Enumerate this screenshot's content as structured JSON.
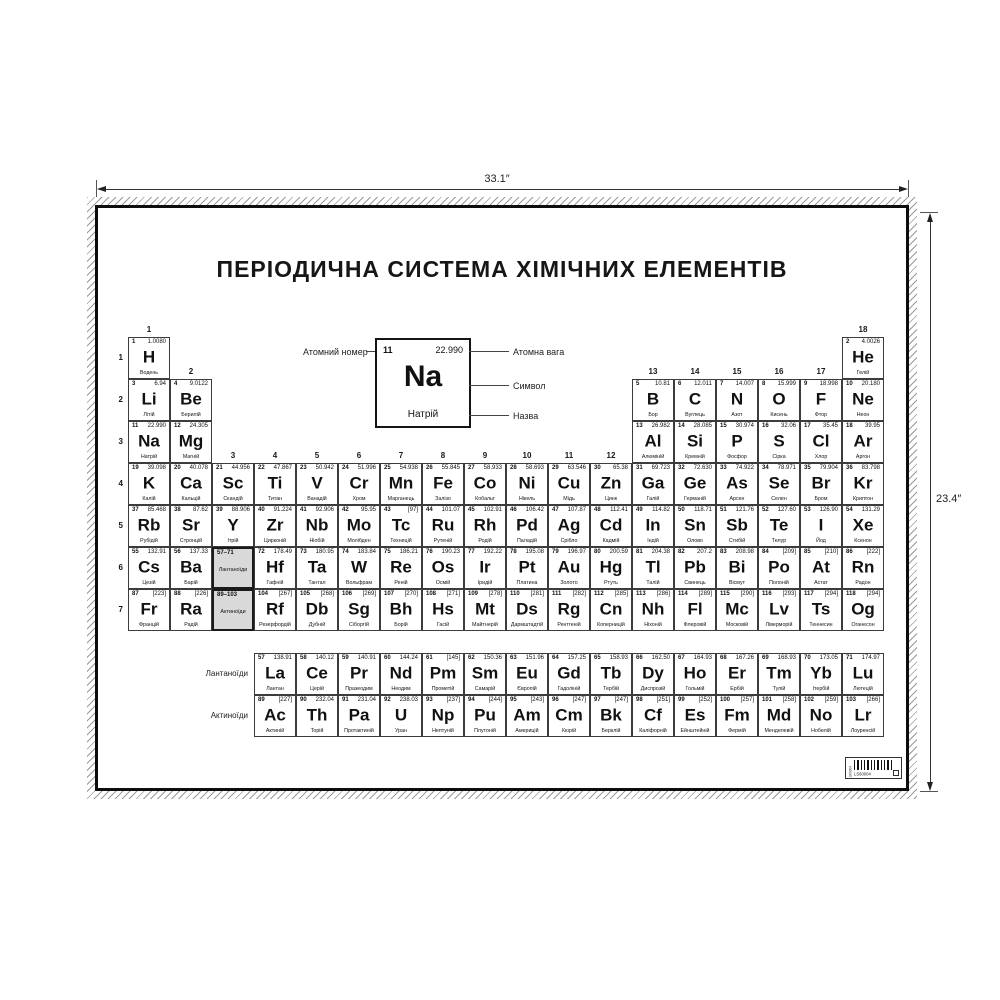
{
  "dimensions": {
    "width_label": "33.1″",
    "height_label": "23.4″"
  },
  "poster": {
    "title": "ПЕРІОДИЧНА СИСТЕМА ХІМІЧНИХ ЕЛЕМЕНТІВ",
    "legend": {
      "atomic_number_label": "Атомний номер",
      "atomic_weight_label": "Атомна вага",
      "symbol_label": "Символ",
      "name_label": "Назва",
      "example": {
        "number": "11",
        "mass": "22.990",
        "symbol": "Na",
        "name": "Натрій"
      }
    },
    "period_labels": [
      "1",
      "2",
      "3",
      "4",
      "5",
      "6",
      "7"
    ],
    "group_headers": [
      {
        "label": "1",
        "col": 1,
        "row": 1
      },
      {
        "label": "2",
        "col": 2,
        "row": 2
      },
      {
        "label": "3",
        "col": 3,
        "row": 4
      },
      {
        "label": "4",
        "col": 4,
        "row": 4
      },
      {
        "label": "5",
        "col": 5,
        "row": 4
      },
      {
        "label": "6",
        "col": 6,
        "row": 4
      },
      {
        "label": "7",
        "col": 7,
        "row": 4
      },
      {
        "label": "8",
        "col": 8,
        "row": 4
      },
      {
        "label": "9",
        "col": 9,
        "row": 4
      },
      {
        "label": "10",
        "col": 10,
        "row": 4
      },
      {
        "label": "11",
        "col": 11,
        "row": 4
      },
      {
        "label": "12",
        "col": 12,
        "row": 4
      },
      {
        "label": "13",
        "col": 13,
        "row": 2
      },
      {
        "label": "14",
        "col": 14,
        "row": 2
      },
      {
        "label": "15",
        "col": 15,
        "row": 2
      },
      {
        "label": "16",
        "col": 16,
        "row": 2
      },
      {
        "label": "17",
        "col": 17,
        "row": 2
      },
      {
        "label": "18",
        "col": 18,
        "row": 1
      }
    ],
    "placeholders": [
      {
        "range": "57–71",
        "label": "Лантаноїди",
        "col": 3,
        "row": 6
      },
      {
        "range": "89–103",
        "label": "Актиноїди",
        "col": 3,
        "row": 7
      }
    ],
    "series_labels": {
      "lanthanides": "Лантаноїди",
      "actinides": "Актиноїди"
    },
    "elements": [
      {
        "n": "1",
        "s": "H",
        "m": "1.0080",
        "name": "Водень",
        "g": 1,
        "p": 1
      },
      {
        "n": "2",
        "s": "He",
        "m": "4.0026",
        "name": "Гелій",
        "g": 18,
        "p": 1
      },
      {
        "n": "3",
        "s": "Li",
        "m": "6.94",
        "name": "Літій",
        "g": 1,
        "p": 2
      },
      {
        "n": "4",
        "s": "Be",
        "m": "9.0122",
        "name": "Берилій",
        "g": 2,
        "p": 2
      },
      {
        "n": "5",
        "s": "B",
        "m": "10.81",
        "name": "Бор",
        "g": 13,
        "p": 2
      },
      {
        "n": "6",
        "s": "C",
        "m": "12.011",
        "name": "Вуглець",
        "g": 14,
        "p": 2
      },
      {
        "n": "7",
        "s": "N",
        "m": "14.007",
        "name": "Азот",
        "g": 15,
        "p": 2
      },
      {
        "n": "8",
        "s": "O",
        "m": "15.999",
        "name": "Кисень",
        "g": 16,
        "p": 2
      },
      {
        "n": "9",
        "s": "F",
        "m": "18.998",
        "name": "Фтор",
        "g": 17,
        "p": 2
      },
      {
        "n": "10",
        "s": "Ne",
        "m": "20.180",
        "name": "Неон",
        "g": 18,
        "p": 2
      },
      {
        "n": "11",
        "s": "Na",
        "m": "22.990",
        "name": "Натрій",
        "g": 1,
        "p": 3
      },
      {
        "n": "12",
        "s": "Mg",
        "m": "24.305",
        "name": "Магній",
        "g": 2,
        "p": 3
      },
      {
        "n": "13",
        "s": "Al",
        "m": "26.982",
        "name": "Алюміній",
        "g": 13,
        "p": 3
      },
      {
        "n": "14",
        "s": "Si",
        "m": "28.085",
        "name": "Кремній",
        "g": 14,
        "p": 3
      },
      {
        "n": "15",
        "s": "P",
        "m": "30.974",
        "name": "Фосфор",
        "g": 15,
        "p": 3
      },
      {
        "n": "16",
        "s": "S",
        "m": "32.06",
        "name": "Сірка",
        "g": 16,
        "p": 3
      },
      {
        "n": "17",
        "s": "Cl",
        "m": "35.45",
        "name": "Хлор",
        "g": 17,
        "p": 3
      },
      {
        "n": "18",
        "s": "Ar",
        "m": "39.95",
        "name": "Аргон",
        "g": 18,
        "p": 3
      },
      {
        "n": "19",
        "s": "K",
        "m": "39.098",
        "name": "Калій",
        "g": 1,
        "p": 4
      },
      {
        "n": "20",
        "s": "Ca",
        "m": "40.078",
        "name": "Кальцій",
        "g": 2,
        "p": 4
      },
      {
        "n": "21",
        "s": "Sc",
        "m": "44.956",
        "name": "Скандій",
        "g": 3,
        "p": 4
      },
      {
        "n": "22",
        "s": "Ti",
        "m": "47.867",
        "name": "Титан",
        "g": 4,
        "p": 4
      },
      {
        "n": "23",
        "s": "V",
        "m": "50.942",
        "name": "Ванадій",
        "g": 5,
        "p": 4
      },
      {
        "n": "24",
        "s": "Cr",
        "m": "51.996",
        "name": "Хром",
        "g": 6,
        "p": 4
      },
      {
        "n": "25",
        "s": "Mn",
        "m": "54.938",
        "name": "Марганець",
        "g": 7,
        "p": 4
      },
      {
        "n": "26",
        "s": "Fe",
        "m": "55.845",
        "name": "Залізо",
        "g": 8,
        "p": 4
      },
      {
        "n": "27",
        "s": "Co",
        "m": "58.933",
        "name": "Кобальт",
        "g": 9,
        "p": 4
      },
      {
        "n": "28",
        "s": "Ni",
        "m": "58.693",
        "name": "Нікель",
        "g": 10,
        "p": 4
      },
      {
        "n": "29",
        "s": "Cu",
        "m": "63.546",
        "name": "Мідь",
        "g": 11,
        "p": 4
      },
      {
        "n": "30",
        "s": "Zn",
        "m": "65.38",
        "name": "Цинк",
        "g": 12,
        "p": 4
      },
      {
        "n": "31",
        "s": "Ga",
        "m": "69.723",
        "name": "Галій",
        "g": 13,
        "p": 4
      },
      {
        "n": "32",
        "s": "Ge",
        "m": "72.630",
        "name": "Германій",
        "g": 14,
        "p": 4
      },
      {
        "n": "33",
        "s": "As",
        "m": "74.922",
        "name": "Арсен",
        "g": 15,
        "p": 4
      },
      {
        "n": "34",
        "s": "Se",
        "m": "78.971",
        "name": "Селен",
        "g": 16,
        "p": 4
      },
      {
        "n": "35",
        "s": "Br",
        "m": "79.904",
        "name": "Бром",
        "g": 17,
        "p": 4
      },
      {
        "n": "36",
        "s": "Kr",
        "m": "83.798",
        "name": "Криптон",
        "g": 18,
        "p": 4
      },
      {
        "n": "37",
        "s": "Rb",
        "m": "85.468",
        "name": "Рубідій",
        "g": 1,
        "p": 5
      },
      {
        "n": "38",
        "s": "Sr",
        "m": "87.62",
        "name": "Стронцій",
        "g": 2,
        "p": 5
      },
      {
        "n": "39",
        "s": "Y",
        "m": "88.906",
        "name": "Ітрій",
        "g": 3,
        "p": 5
      },
      {
        "n": "40",
        "s": "Zr",
        "m": "91.224",
        "name": "Цирконій",
        "g": 4,
        "p": 5
      },
      {
        "n": "41",
        "s": "Nb",
        "m": "92.906",
        "name": "Ніобій",
        "g": 5,
        "p": 5
      },
      {
        "n": "42",
        "s": "Mo",
        "m": "95.95",
        "name": "Молібден",
        "g": 6,
        "p": 5
      },
      {
        "n": "43",
        "s": "Tc",
        "m": "[97]",
        "name": "Технецій",
        "g": 7,
        "p": 5
      },
      {
        "n": "44",
        "s": "Ru",
        "m": "101.07",
        "name": "Рутеній",
        "g": 8,
        "p": 5
      },
      {
        "n": "45",
        "s": "Rh",
        "m": "102.91",
        "name": "Родій",
        "g": 9,
        "p": 5
      },
      {
        "n": "46",
        "s": "Pd",
        "m": "106.42",
        "name": "Паладій",
        "g": 10,
        "p": 5
      },
      {
        "n": "47",
        "s": "Ag",
        "m": "107.87",
        "name": "Срібло",
        "g": 11,
        "p": 5
      },
      {
        "n": "48",
        "s": "Cd",
        "m": "112.41",
        "name": "Кадмій",
        "g": 12,
        "p": 5
      },
      {
        "n": "49",
        "s": "In",
        "m": "114.82",
        "name": "Індій",
        "g": 13,
        "p": 5
      },
      {
        "n": "50",
        "s": "Sn",
        "m": "118.71",
        "name": "Олово",
        "g": 14,
        "p": 5
      },
      {
        "n": "51",
        "s": "Sb",
        "m": "121.76",
        "name": "Стибій",
        "g": 15,
        "p": 5
      },
      {
        "n": "52",
        "s": "Te",
        "m": "127.60",
        "name": "Телур",
        "g": 16,
        "p": 5
      },
      {
        "n": "53",
        "s": "I",
        "m": "126.90",
        "name": "Йод",
        "g": 17,
        "p": 5
      },
      {
        "n": "54",
        "s": "Xe",
        "m": "131.29",
        "name": "Ксенон",
        "g": 18,
        "p": 5
      },
      {
        "n": "55",
        "s": "Cs",
        "m": "132.91",
        "name": "Цезій",
        "g": 1,
        "p": 6
      },
      {
        "n": "56",
        "s": "Ba",
        "m": "137.33",
        "name": "Барій",
        "g": 2,
        "p": 6
      },
      {
        "n": "72",
        "s": "Hf",
        "m": "178.49",
        "name": "Гафній",
        "g": 4,
        "p": 6
      },
      {
        "n": "73",
        "s": "Ta",
        "m": "180.95",
        "name": "Тантал",
        "g": 5,
        "p": 6
      },
      {
        "n": "74",
        "s": "W",
        "m": "183.84",
        "name": "Вольфрам",
        "g": 6,
        "p": 6
      },
      {
        "n": "75",
        "s": "Re",
        "m": "186.21",
        "name": "Реній",
        "g": 7,
        "p": 6
      },
      {
        "n": "76",
        "s": "Os",
        "m": "190.23",
        "name": "Осмій",
        "g": 8,
        "p": 6
      },
      {
        "n": "77",
        "s": "Ir",
        "m": "192.22",
        "name": "Іридій",
        "g": 9,
        "p": 6
      },
      {
        "n": "78",
        "s": "Pt",
        "m": "195.08",
        "name": "Платина",
        "g": 10,
        "p": 6
      },
      {
        "n": "79",
        "s": "Au",
        "m": "196.97",
        "name": "Золото",
        "g": 11,
        "p": 6
      },
      {
        "n": "80",
        "s": "Hg",
        "m": "200.59",
        "name": "Ртуть",
        "g": 12,
        "p": 6
      },
      {
        "n": "81",
        "s": "Tl",
        "m": "204.38",
        "name": "Талій",
        "g": 13,
        "p": 6
      },
      {
        "n": "82",
        "s": "Pb",
        "m": "207.2",
        "name": "Свинець",
        "g": 14,
        "p": 6
      },
      {
        "n": "83",
        "s": "Bi",
        "m": "208.98",
        "name": "Вісмут",
        "g": 15,
        "p": 6
      },
      {
        "n": "84",
        "s": "Po",
        "m": "[209]",
        "name": "Полоній",
        "g": 16,
        "p": 6
      },
      {
        "n": "85",
        "s": "At",
        "m": "[210]",
        "name": "Астат",
        "g": 17,
        "p": 6
      },
      {
        "n": "86",
        "s": "Rn",
        "m": "[222]",
        "name": "Радон",
        "g": 18,
        "p": 6
      },
      {
        "n": "87",
        "s": "Fr",
        "m": "[223]",
        "name": "Францій",
        "g": 1,
        "p": 7
      },
      {
        "n": "88",
        "s": "Ra",
        "m": "[226]",
        "name": "Радій",
        "g": 2,
        "p": 7
      },
      {
        "n": "104",
        "s": "Rf",
        "m": "[267]",
        "name": "Резерфордій",
        "g": 4,
        "p": 7
      },
      {
        "n": "105",
        "s": "Db",
        "m": "[268]",
        "name": "Дубній",
        "g": 5,
        "p": 7
      },
      {
        "n": "106",
        "s": "Sg",
        "m": "[269]",
        "name": "Сіборгій",
        "g": 6,
        "p": 7
      },
      {
        "n": "107",
        "s": "Bh",
        "m": "[270]",
        "name": "Борій",
        "g": 7,
        "p": 7
      },
      {
        "n": "108",
        "s": "Hs",
        "m": "[271]",
        "name": "Гасій",
        "g": 8,
        "p": 7
      },
      {
        "n": "109",
        "s": "Mt",
        "m": "[278]",
        "name": "Майтнерій",
        "g": 9,
        "p": 7
      },
      {
        "n": "110",
        "s": "Ds",
        "m": "[281]",
        "name": "Дармштадтій",
        "g": 10,
        "p": 7
      },
      {
        "n": "111",
        "s": "Rg",
        "m": "[282]",
        "name": "Рентгеній",
        "g": 11,
        "p": 7
      },
      {
        "n": "112",
        "s": "Cn",
        "m": "[285]",
        "name": "Коперницій",
        "g": 12,
        "p": 7
      },
      {
        "n": "113",
        "s": "Nh",
        "m": "[286]",
        "name": "Ніхоній",
        "g": 13,
        "p": 7
      },
      {
        "n": "114",
        "s": "Fl",
        "m": "[289]",
        "name": "Флеровій",
        "g": 14,
        "p": 7
      },
      {
        "n": "115",
        "s": "Mc",
        "m": "[290]",
        "name": "Московій",
        "g": 15,
        "p": 7
      },
      {
        "n": "116",
        "s": "Lv",
        "m": "[293]",
        "name": "Ліверморій",
        "g": 16,
        "p": 7
      },
      {
        "n": "117",
        "s": "Ts",
        "m": "[294]",
        "name": "Теннесин",
        "g": 17,
        "p": 7
      },
      {
        "n": "118",
        "s": "Og",
        "m": "[294]",
        "name": "Оганесон",
        "g": 18,
        "p": 7
      }
    ],
    "lanthanides": [
      {
        "n": "57",
        "s": "La",
        "m": "138.91",
        "name": "Лантан"
      },
      {
        "n": "58",
        "s": "Ce",
        "m": "140.12",
        "name": "Церій"
      },
      {
        "n": "59",
        "s": "Pr",
        "m": "140.91",
        "name": "Празеодим"
      },
      {
        "n": "60",
        "s": "Nd",
        "m": "144.24",
        "name": "Неодим"
      },
      {
        "n": "61",
        "s": "Pm",
        "m": "[145]",
        "name": "Прометій"
      },
      {
        "n": "62",
        "s": "Sm",
        "m": "150.36",
        "name": "Самарій"
      },
      {
        "n": "63",
        "s": "Eu",
        "m": "151.96",
        "name": "Європій"
      },
      {
        "n": "64",
        "s": "Gd",
        "m": "157.25",
        "name": "Гадоліній"
      },
      {
        "n": "65",
        "s": "Tb",
        "m": "158.93",
        "name": "Тербій"
      },
      {
        "n": "66",
        "s": "Dy",
        "m": "162.50",
        "name": "Диспрозій"
      },
      {
        "n": "67",
        "s": "Ho",
        "m": "164.93",
        "name": "Гольмій"
      },
      {
        "n": "68",
        "s": "Er",
        "m": "167.26",
        "name": "Ербій"
      },
      {
        "n": "69",
        "s": "Tm",
        "m": "168.93",
        "name": "Тулій"
      },
      {
        "n": "70",
        "s": "Yb",
        "m": "173.05",
        "name": "Ітербій"
      },
      {
        "n": "71",
        "s": "Lu",
        "m": "174.97",
        "name": "Лютецій"
      }
    ],
    "actinides": [
      {
        "n": "89",
        "s": "Ac",
        "m": "[227]",
        "name": "Актиній"
      },
      {
        "n": "90",
        "s": "Th",
        "m": "232.04",
        "name": "Торій"
      },
      {
        "n": "91",
        "s": "Pa",
        "m": "231.04",
        "name": "Протактиній"
      },
      {
        "n": "92",
        "s": "U",
        "m": "238.03",
        "name": "Уран"
      },
      {
        "n": "93",
        "s": "Np",
        "m": "[237]",
        "name": "Нептуній"
      },
      {
        "n": "94",
        "s": "Pu",
        "m": "[244]",
        "name": "Плутоній"
      },
      {
        "n": "95",
        "s": "Am",
        "m": "[243]",
        "name": "Америцій"
      },
      {
        "n": "96",
        "s": "Cm",
        "m": "[247]",
        "name": "Кюрій"
      },
      {
        "n": "97",
        "s": "Bk",
        "m": "[247]",
        "name": "Берклій"
      },
      {
        "n": "98",
        "s": "Cf",
        "m": "[251]",
        "name": "Каліфорній"
      },
      {
        "n": "99",
        "s": "Es",
        "m": "[252]",
        "name": "Ейнштейній"
      },
      {
        "n": "100",
        "s": "Fm",
        "m": "[257]",
        "name": "Фермій"
      },
      {
        "n": "101",
        "s": "Md",
        "m": "[258]",
        "name": "Менделевій"
      },
      {
        "n": "102",
        "s": "No",
        "m": "[259]",
        "name": "Нобелій"
      },
      {
        "n": "103",
        "s": "Lr",
        "m": "[266]",
        "name": "Лоуренсій"
      }
    ],
    "barcode_text": "LS60004"
  }
}
